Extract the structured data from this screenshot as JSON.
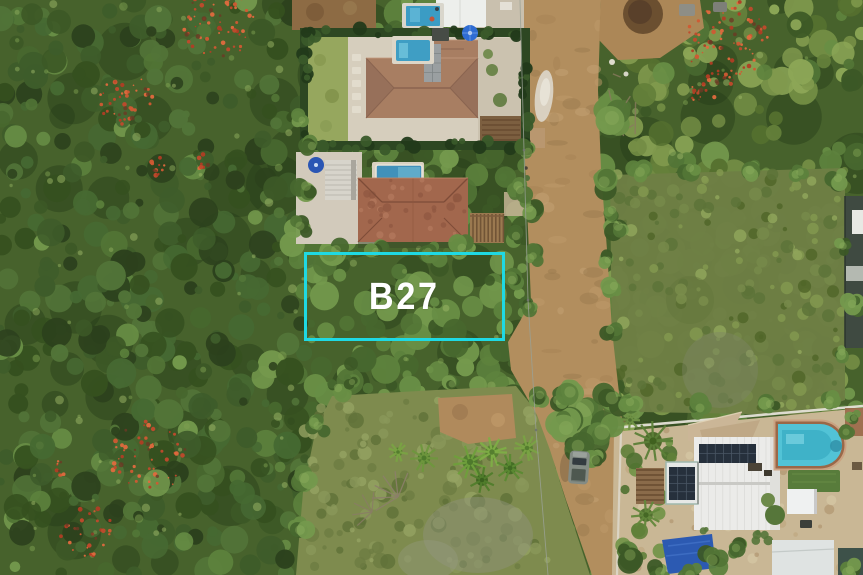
{
  "photo": {
    "kind": "aerial-drone-photograph",
    "lot_marker": {
      "label": "B27",
      "outline_color": "#1fd9e3",
      "label_color": "#ffffff"
    },
    "palette": {
      "forest_green": "#4a6530",
      "scrub_green": "#6e7f45",
      "grass_olive": "#7e8b4e",
      "road_dirt": "#b28e5e",
      "pool_water": "#3f9ec4",
      "roof_terracotta": "#a2674d",
      "white_roof": "#ebebe9",
      "solar_panel": "#26303c",
      "flame_tree_red": "#c14a2c"
    }
  }
}
